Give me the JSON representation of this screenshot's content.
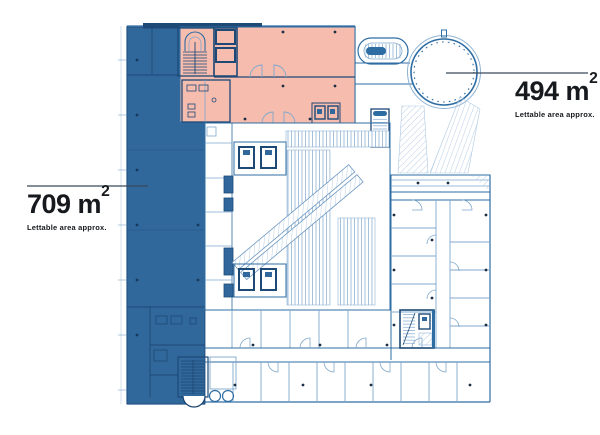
{
  "labels": {
    "blue_area": {
      "value": "709 m",
      "sup": "2",
      "caption": "Lettable area approx."
    },
    "pink_area": {
      "value": "494 m",
      "sup": "2",
      "caption": "Lettable area approx."
    }
  },
  "colors": {
    "area_blue": "#31689B",
    "area_pink": "#F6BCAE",
    "wall_dark": "#1D4977",
    "wall_medium": "#2E6DA3",
    "line_light": "#A9C5DF",
    "leader": "#3A4A5A",
    "text": "#16191D",
    "dot": "#1B2E44"
  }
}
